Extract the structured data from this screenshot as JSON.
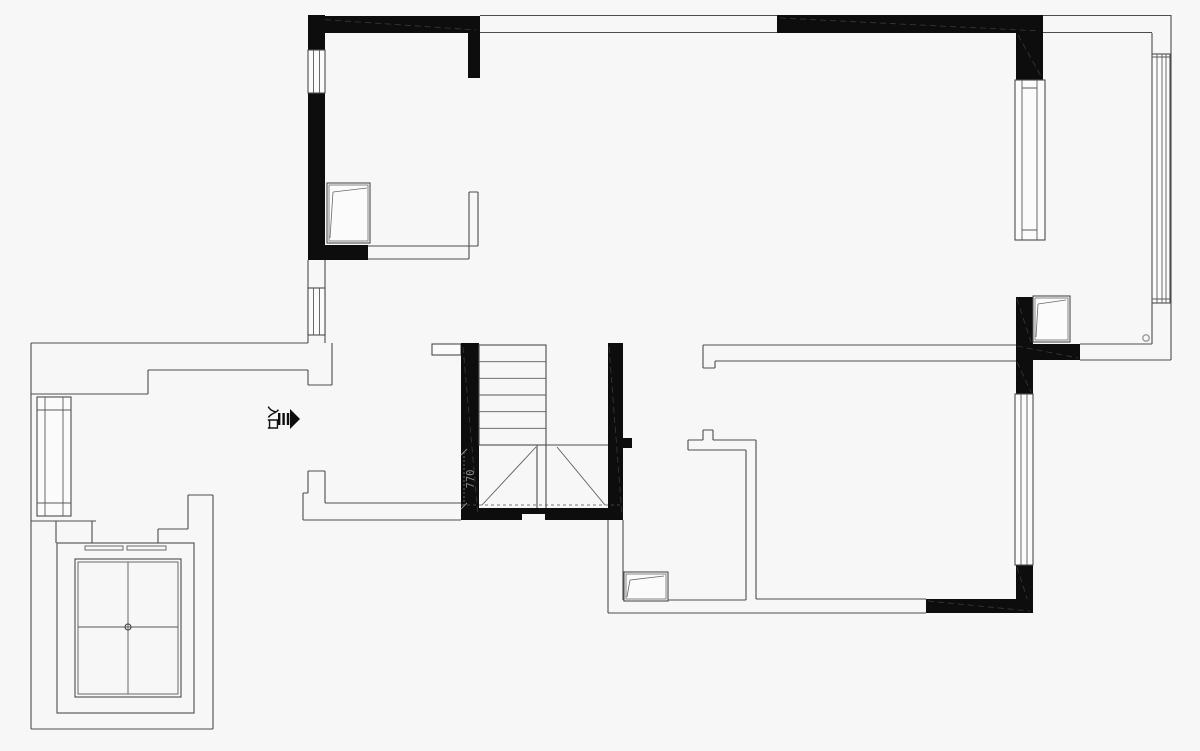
{
  "page": {
    "background": "#f7f7f7",
    "kind": "architectural floor plan"
  },
  "palette": {
    "wall_fill": "#0d0d0d",
    "line": "#4d4d4d",
    "hatch": "#3a3a3a",
    "dimension_text": "#8c8c8c",
    "label_text": "#111111"
  },
  "labels": {
    "entrance": "入口",
    "stair_dimension": "770"
  },
  "symbols": {
    "entry_arrow": "entry-direction-arrow",
    "casement_windows": 3,
    "sliding_windows": 6,
    "elevator": "elevator-shaft-with-cross",
    "staircase": "double-flight-stair",
    "hinge_circle": "small-circle-symbol"
  }
}
